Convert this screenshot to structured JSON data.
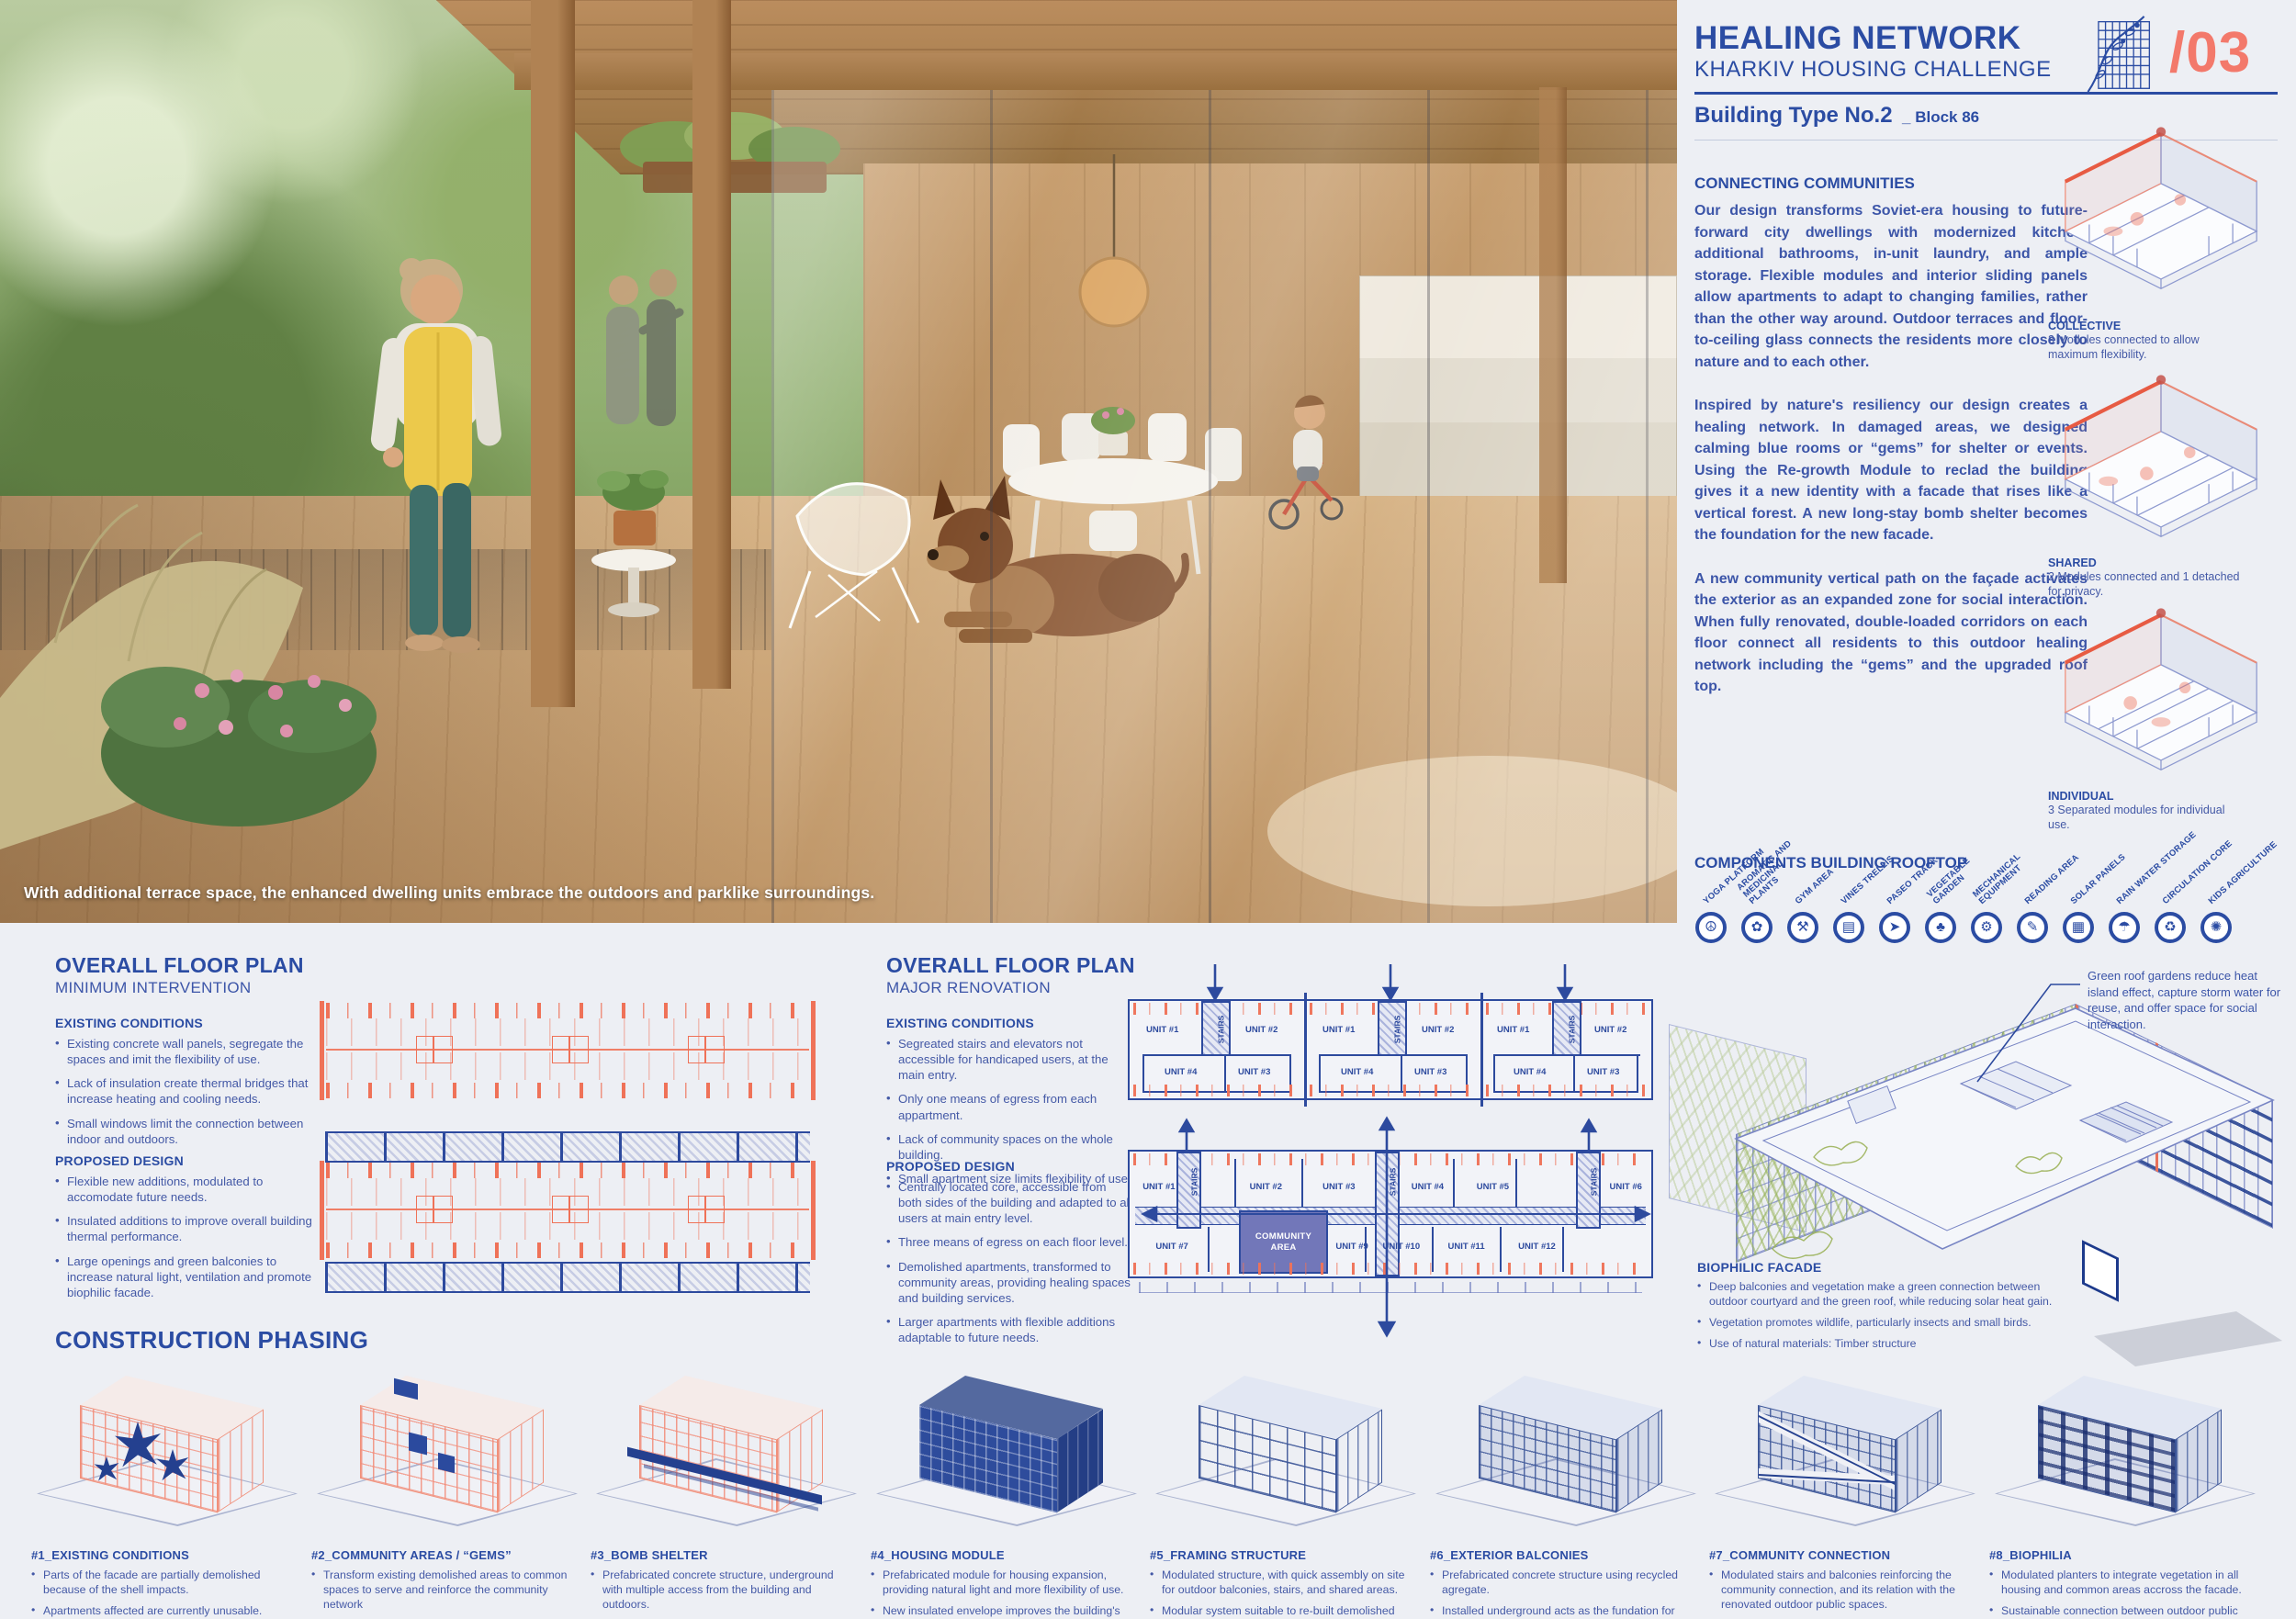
{
  "header": {
    "title": "HEALING NETWORK",
    "subtitle": "KHARKIV HOUSING CHALLENGE",
    "building_type": "Building Type No.2",
    "block_label": "_ Block 86",
    "page_number": "/03"
  },
  "colors": {
    "blue": "#2b4ca3",
    "coral": "#f3796b",
    "navy": "#2d4a9e",
    "purple": "#7277b9",
    "green": "#a6c263"
  },
  "photo": {
    "caption": "With additional terrace space, the enhanced dwelling units embrace the outdoors and parklike surroundings."
  },
  "connecting": {
    "heading": "CONNECTING COMMUNITIES",
    "paragraphs": [
      "Our design transforms Soviet-era housing to future-forward city dwellings with modernized kitchen, additional bathrooms, in-unit laundry, and ample storage. Flexible modules and interior sliding panels allow apartments to adapt to changing families, rather than the other way around. Outdoor terraces and floor-to-ceiling glass connects the residents more closely to nature and to each other.",
      "Inspired by nature's resiliency our design creates a healing network. In damaged areas, we designed calming blue rooms or “gems” for shelter or events. Using the Re-growth Module to reclad the building gives it a new identity with a facade that rises like a vertical forest. A new long-stay bomb shelter becomes the foundation for the new facade.",
      "A new community vertical path on the façade activates the exterior as an expanded zone for social interaction. When fully renovated, double-loaded corridors on each floor connect all residents to this outdoor healing network including the “gems” and the upgraded roof top."
    ]
  },
  "modules": [
    {
      "name": "COLLECTIVE",
      "desc": "3 Modules connected to allow maximum flexibility."
    },
    {
      "name": "SHARED",
      "desc": "2 Modules connected and 1 detached for privacy."
    },
    {
      "name": "INDIVIDUAL",
      "desc": "3 Separated modules for individual use."
    }
  ],
  "rooftop": {
    "heading": "COMPONENTS BUILDING ROOFTOP",
    "items": [
      {
        "label": "YOGA PLATFORM",
        "glyph": "☮"
      },
      {
        "label": "AROMATIC AND MEDICINAL PLANTS",
        "glyph": "✿"
      },
      {
        "label": "GYM AREA",
        "glyph": "⚒"
      },
      {
        "label": "VINES TRELLIS",
        "glyph": "▤"
      },
      {
        "label": "PASEO TRACK",
        "glyph": "➤"
      },
      {
        "label": "VEGETABLE GARDEN",
        "glyph": "♣"
      },
      {
        "label": "MECHANICAL EQUIPMENT",
        "glyph": "⚙"
      },
      {
        "label": "READING AREA",
        "glyph": "✎"
      },
      {
        "label": "SOLAR PANELS",
        "glyph": "▦"
      },
      {
        "label": "RAIN WATER STORAGE",
        "glyph": "☂"
      },
      {
        "label": "CIRCULATION CORE",
        "glyph": "♻"
      },
      {
        "label": "KIDS AGRICULTURE",
        "glyph": "✺"
      }
    ]
  },
  "fp_min": {
    "title": "OVERALL FLOOR PLAN",
    "subtitle": "MINIMUM INTERVENTION",
    "existing_heading": "EXISTING CONDITIONS",
    "existing": [
      "Existing concrete wall panels, segregate the spaces and imit the flexibility of use.",
      "Lack of insulation create thermal bridges that increase heating and cooling needs.",
      "Small windows limit the connection between indoor and outdoors."
    ],
    "proposed_heading": "PROPOSED DESIGN",
    "proposed": [
      "Flexible new additions, modulated to accomodate future needs.",
      "Insulated additions to improve overall building thermal performance.",
      "Large openings and green balconies to increase natural light, ventilation and promote biophilic facade."
    ]
  },
  "fp_major": {
    "title": "OVERALL FLOOR PLAN",
    "subtitle": "MAJOR RENOVATION",
    "existing_heading": "EXISTING CONDITIONS",
    "existing": [
      "Segreated stairs and elevators not accessible for handicaped users, at the main entry.",
      "Only one means of egress from each appartment.",
      "Lack of community spaces on the whole building.",
      "Small apartment size limits flexibility of use."
    ],
    "proposed_heading": "PROPOSED DESIGN",
    "proposed": [
      "Centrally located core, accessible from both sides of the building and adapted to all users at main entry level.",
      "Three means of egress on each floor level.",
      "Demolished apartments, transformed to community areas, providing healing spaces and building services.",
      "Larger apartments with flexible additions adaptable to future needs."
    ]
  },
  "plan_labels": {
    "unit1": "UNIT #1",
    "unit2": "UNIT #2",
    "unit3": "UNIT #3",
    "unit4": "UNIT #4",
    "unit5": "UNIT #5",
    "unit6": "UNIT #6",
    "unit7": "UNIT #7",
    "unit9": "UNIT #9",
    "unit10": "UNIT #10",
    "unit11": "UNIT #11",
    "unit12": "UNIT #12",
    "stairs": "STAIRS",
    "community1": "COMMUNITY",
    "community2": "AREA"
  },
  "axon": {
    "note": "Green roof gardens reduce heat island effect, capture storm water for reuse, and offer space for social interaction.",
    "biophilic_heading": "BIOPHILIC FACADE",
    "biophilic": [
      "Deep balconies and vegetation make a green connection between outdoor courtyard and the green roof, while reducing solar heat gain.",
      "Vegetation promotes wildlife, particularly insects and small birds.",
      "Use of natural materials: Timber structure"
    ]
  },
  "phasing": {
    "heading": "CONSTRUCTION PHASING",
    "items": [
      {
        "title": "#1_EXISTING CONDITIONS",
        "bullets": [
          "Parts of the facade are partially demolished because of the shell impacts.",
          "Apartments affected are currently unusable."
        ]
      },
      {
        "title": "#2_COMMUNITY AREAS / “GEMS”",
        "bullets": [
          "Transform existing demolished areas to common spaces to serve and reinforce the community network",
          "Relocate affected users to the new re-built buildings."
        ]
      },
      {
        "title": "#3_BOMB SHELTER",
        "bullets": [
          "Prefabricated concrete structure, underground with multiple access from the building and outdoors.",
          "Bomb shelter serves as foundation and base for housing modules and balconies above."
        ]
      },
      {
        "title": "#4_HOUSING MODULE",
        "bullets": [
          "Prefabricated module for housing expansion, providing natural light and more flexibility of use.",
          "New insulated envelope improves the building's thermal comfort."
        ]
      },
      {
        "title": "#5_FRAMING STRUCTURE",
        "bullets": [
          "Modulated structure, with quick assembly on site for outdoor balconies, stairs, and shared areas.",
          "Modular system suitable to re-built demolished buildings"
        ]
      },
      {
        "title": "#6_EXTERIOR BALCONIES",
        "bullets": [
          "Prefabricated concrete structure using recycled agregate.",
          "Installed underground acts as the fundation for the"
        ]
      },
      {
        "title": "#7_COMMUNITY CONNECTION",
        "bullets": [
          "Modulated stairs and balconies reinforcing the community connection, and its relation with the renovated outdoor public spaces."
        ]
      },
      {
        "title": "#8_BIOPHILIA",
        "bullets": [
          "Modulated planters to integrate vegetation in all housing and common areas accross the facade.",
          "Sustainable connection between outdoor public spaces, balconies and the green roof"
        ]
      }
    ]
  }
}
